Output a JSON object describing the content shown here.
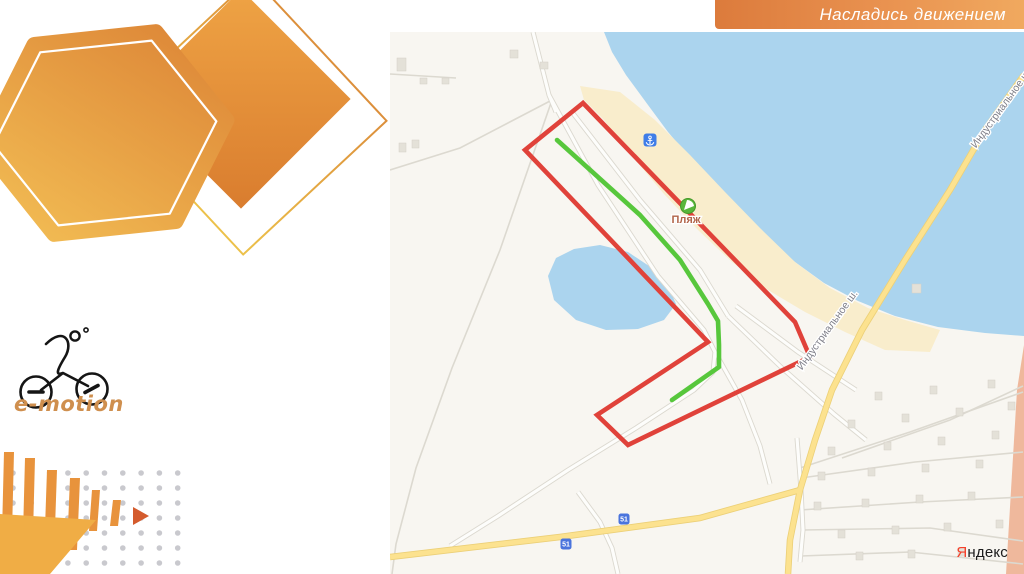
{
  "banner": {
    "text": "Насладись движением",
    "bg_from": "#dc7b3c",
    "bg_to": "#f0a95f",
    "text_color": "#ffffff"
  },
  "logo": {
    "text": "e-motion",
    "color": "#cf8f4e"
  },
  "decor": {
    "accent_orange": "#e8933c",
    "accent_orange_light": "#f0ad45",
    "arrow_tip_color": "#d45b2d",
    "dot_color": "#c9c9ce",
    "dots": {
      "x0": 13,
      "dx": 18.3,
      "nx": 10,
      "y0": 33,
      "dy": 15,
      "ny": 7,
      "r": 2.8
    }
  },
  "map": {
    "colors": {
      "bg": "#f8f6f1",
      "water": "#abd4ee",
      "sand": "#f9edcc",
      "salmon_zone": "#efb89c",
      "road_casing": "#dbd8cf",
      "road_fill": "#fdfdfb",
      "thin_road": "#dcd9d0",
      "yellow_casing": "#ecd078",
      "yellow_fill": "#fce28f",
      "building": "#e4e1d8",
      "building_border": "#d3d0c6",
      "route_red": "#e0423a",
      "route_green": "#57c73c",
      "shield_blue": "#4a74dd",
      "anchor_blue": "#3f7de8",
      "beach_green": "#58b63b",
      "beach_ring": "#459929"
    },
    "water_polygon": [
      [
        604,
        32
      ],
      [
        612,
        52
      ],
      [
        626,
        75
      ],
      [
        648,
        105
      ],
      [
        668,
        132
      ],
      [
        690,
        158
      ],
      [
        712,
        182
      ],
      [
        740,
        212
      ],
      [
        768,
        240
      ],
      [
        795,
        262
      ],
      [
        824,
        283
      ],
      [
        858,
        301
      ],
      [
        895,
        316
      ],
      [
        938,
        327
      ],
      [
        985,
        333
      ],
      [
        1024,
        336
      ],
      [
        1024,
        32
      ]
    ],
    "sand_polygon": [
      [
        580,
        86
      ],
      [
        620,
        92
      ],
      [
        655,
        120
      ],
      [
        690,
        155
      ],
      [
        725,
        192
      ],
      [
        760,
        228
      ],
      [
        795,
        262
      ],
      [
        830,
        288
      ],
      [
        868,
        308
      ],
      [
        905,
        320
      ],
      [
        940,
        330
      ],
      [
        930,
        352
      ],
      [
        885,
        350
      ],
      [
        845,
        332
      ],
      [
        805,
        312
      ],
      [
        768,
        290
      ],
      [
        732,
        262
      ],
      [
        698,
        230
      ],
      [
        664,
        194
      ],
      [
        632,
        156
      ],
      [
        604,
        120
      ],
      [
        584,
        100
      ]
    ],
    "pond_polygon": [
      [
        548,
        276
      ],
      [
        556,
        258
      ],
      [
        574,
        249
      ],
      [
        600,
        245
      ],
      [
        628,
        252
      ],
      [
        652,
        268
      ],
      [
        668,
        286
      ],
      [
        676,
        304
      ],
      [
        664,
        320
      ],
      [
        638,
        329
      ],
      [
        606,
        330
      ],
      [
        576,
        320
      ],
      [
        554,
        300
      ]
    ],
    "salmon_polygon": [
      [
        1024,
        345
      ],
      [
        1017,
        390
      ],
      [
        1006,
        574
      ],
      [
        1024,
        574
      ]
    ],
    "red_route": [
      [
        583,
        103
      ],
      [
        525,
        150
      ],
      [
        708,
        342
      ],
      [
        597,
        415
      ],
      [
        628,
        445
      ],
      [
        810,
        357
      ],
      [
        795,
        322
      ]
    ],
    "green_route": [
      [
        557,
        140
      ],
      [
        640,
        215
      ],
      [
        680,
        260
      ],
      [
        708,
        304
      ],
      [
        718,
        321
      ],
      [
        719,
        345
      ],
      [
        719,
        367
      ],
      [
        672,
        400
      ]
    ],
    "yellow_roads": [
      [
        [
          1024,
          75
        ],
        [
          985,
          130
        ],
        [
          950,
          190
        ],
        [
          905,
          260
        ],
        [
          862,
          330
        ],
        [
          832,
          390
        ],
        [
          815,
          440
        ],
        [
          800,
          490
        ],
        [
          790,
          540
        ],
        [
          788,
          574
        ]
      ],
      [
        [
          800,
          490
        ],
        [
          700,
          518
        ],
        [
          560,
          537
        ],
        [
          390,
          557
        ]
      ]
    ],
    "roads": [
      [
        [
          533,
          32
        ],
        [
          549,
          95
        ],
        [
          556,
          112
        ]
      ],
      [
        [
          549,
          95
        ],
        [
          598,
          185
        ],
        [
          658,
          276
        ],
        [
          704,
          330
        ],
        [
          715,
          352
        ],
        [
          713,
          372
        ],
        [
          694,
          390
        ],
        [
          636,
          428
        ],
        [
          568,
          470
        ],
        [
          498,
          516
        ],
        [
          450,
          546
        ]
      ],
      [
        [
          715,
          352
        ],
        [
          742,
          400
        ],
        [
          760,
          446
        ],
        [
          770,
          484
        ]
      ],
      [
        [
          572,
          112
        ],
        [
          640,
          200
        ],
        [
          700,
          270
        ],
        [
          728,
          316
        ]
      ],
      [
        [
          728,
          316
        ],
        [
          782,
          368
        ],
        [
          834,
          414
        ],
        [
          866,
          440
        ]
      ],
      [
        [
          736,
          306
        ],
        [
          798,
          352
        ],
        [
          856,
          390
        ]
      ],
      [
        [
          578,
          492
        ],
        [
          600,
          522
        ],
        [
          612,
          548
        ],
        [
          618,
          574
        ]
      ],
      [
        [
          797,
          438
        ],
        [
          801,
          490
        ],
        [
          803,
          530
        ],
        [
          800,
          562
        ]
      ]
    ],
    "thin_roads": [
      [
        [
          390,
          74
        ],
        [
          456,
          78
        ]
      ],
      [
        [
          390,
          170
        ],
        [
          460,
          148
        ],
        [
          552,
          100
        ]
      ],
      [
        [
          552,
          100
        ],
        [
          500,
          250
        ],
        [
          452,
          368
        ],
        [
          416,
          468
        ],
        [
          396,
          544
        ],
        [
          392,
          574
        ]
      ],
      [
        [
          800,
          468
        ],
        [
          910,
          432
        ],
        [
          1023,
          392
        ]
      ],
      [
        [
          801,
          478
        ],
        [
          915,
          462
        ],
        [
          1023,
          452
        ]
      ],
      [
        [
          800,
          510
        ],
        [
          920,
          502
        ],
        [
          1023,
          497
        ]
      ],
      [
        [
          802,
          530
        ],
        [
          930,
          528
        ],
        [
          1023,
          541
        ]
      ],
      [
        [
          801,
          556
        ],
        [
          910,
          552
        ],
        [
          1023,
          564
        ]
      ],
      [
        [
          842,
          458
        ],
        [
          950,
          420
        ],
        [
          1023,
          386
        ]
      ]
    ],
    "buildings": [
      [
        397,
        58,
        9,
        13
      ],
      [
        420,
        78,
        7,
        6
      ],
      [
        442,
        78,
        7,
        6
      ],
      [
        510,
        50,
        8,
        8
      ],
      [
        540,
        62,
        8,
        7
      ],
      [
        399,
        143,
        7,
        9
      ],
      [
        412,
        140,
        7,
        8
      ],
      [
        912,
        284,
        9,
        9
      ],
      [
        875,
        392,
        7,
        8
      ],
      [
        930,
        386,
        7,
        8
      ],
      [
        988,
        380,
        7,
        8
      ],
      [
        848,
        420,
        7,
        8
      ],
      [
        902,
        414,
        7,
        8
      ],
      [
        956,
        408,
        7,
        8
      ],
      [
        1008,
        402,
        7,
        8
      ],
      [
        828,
        447,
        7,
        8
      ],
      [
        884,
        442,
        7,
        8
      ],
      [
        938,
        437,
        7,
        8
      ],
      [
        992,
        431,
        7,
        8
      ],
      [
        818,
        472,
        7,
        8
      ],
      [
        868,
        468,
        7,
        8
      ],
      [
        922,
        464,
        7,
        8
      ],
      [
        976,
        460,
        7,
        8
      ],
      [
        814,
        502,
        7,
        8
      ],
      [
        862,
        499,
        7,
        8
      ],
      [
        916,
        495,
        7,
        8
      ],
      [
        968,
        492,
        7,
        8
      ],
      [
        838,
        530,
        7,
        8
      ],
      [
        892,
        526,
        7,
        8
      ],
      [
        944,
        523,
        7,
        8
      ],
      [
        996,
        520,
        7,
        8
      ],
      [
        856,
        552,
        7,
        8
      ],
      [
        908,
        550,
        7,
        8
      ],
      [
        958,
        548,
        7,
        8
      ]
    ],
    "labels": [
      {
        "text": "Пляж",
        "x": 686,
        "y": 223,
        "rotate": 0,
        "color": "#b2654a",
        "size": 11,
        "bold": true
      },
      {
        "text": "Индустриальное ш.",
        "x": 830,
        "y": 332,
        "rotate": -54,
        "color": "#7e7e88",
        "size": 10.5,
        "bold": false
      },
      {
        "text": "Индустриальное ш.",
        "x": 1004,
        "y": 110,
        "rotate": -54,
        "color": "#7e7e88",
        "size": 10.5,
        "bold": false
      }
    ],
    "shield_text": "51",
    "shields": [
      {
        "x": 624,
        "y": 519
      },
      {
        "x": 566,
        "y": 544
      }
    ],
    "anchor_icon": {
      "x": 650,
      "y": 140
    },
    "beach_icon": {
      "x": 688,
      "y": 206
    },
    "attribution": {
      "first": "Я",
      "rest": "ндекс"
    }
  }
}
